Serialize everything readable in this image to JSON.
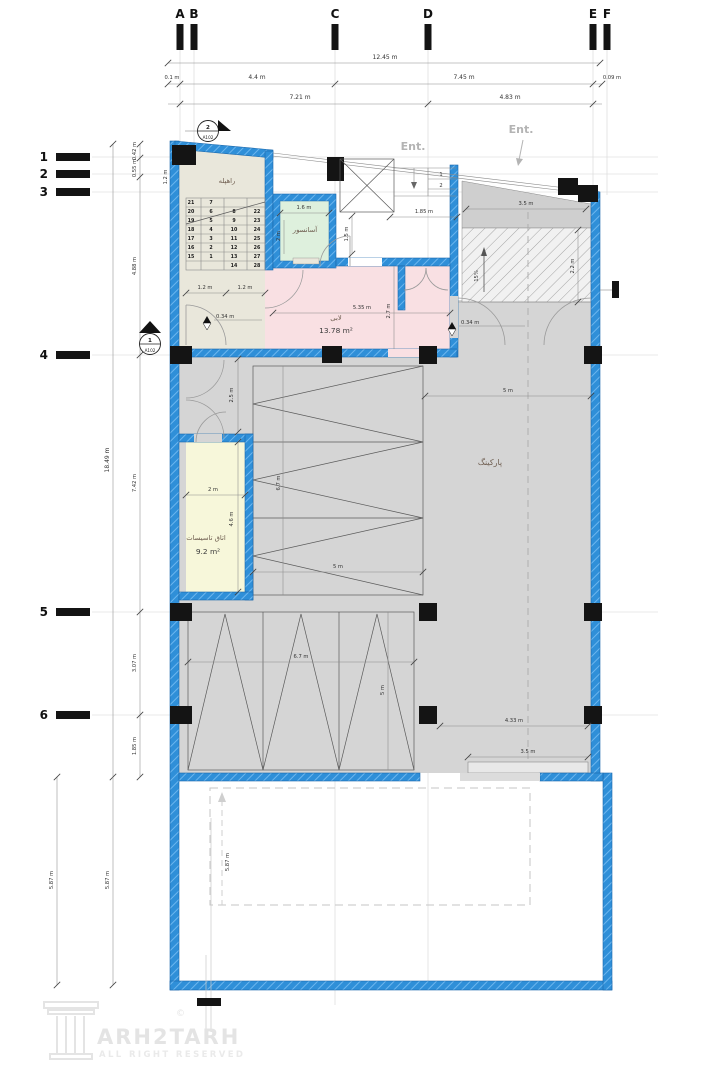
{
  "grid": {
    "cols": [
      "A",
      "B",
      "C",
      "D",
      "E",
      "F"
    ],
    "rows": [
      "1",
      "2",
      "3",
      "4",
      "5",
      "6"
    ]
  },
  "rooms": {
    "stair": {
      "name": "راهپله"
    },
    "elevator": {
      "name": "آسانسور"
    },
    "lobby": {
      "name": "لابی",
      "area": "13.78 m²"
    },
    "utility": {
      "name": "اتاق تاسیسات",
      "area": "9.2 m²"
    },
    "parking": {
      "name": "پارکینگ"
    }
  },
  "labels": {
    "ent1": "Ent.",
    "ent2": "Ent.",
    "step1": "1",
    "step2": "2"
  },
  "dims": {
    "total_top": "12.45 m",
    "seg_a": "0.1 m",
    "seg_bc": "4.4 m",
    "seg_ce": "7.45 m",
    "seg_ef": "0.09 m",
    "span_ad": "7.21 m",
    "span_de": "4.83 m",
    "row12": "0.42 m",
    "row23": "0.55 m",
    "row34": "4.88 m",
    "left_total": "18.49 m",
    "row45": "7.42 m",
    "row56": "3.07 m",
    "row6w": "1.85 m",
    "yard_left1": "5.87 m",
    "yard_left2": "5.87 m",
    "yard_inner": "5.87 m",
    "stair_top": "1.2 m",
    "stair_w1": "1.2 m",
    "stair_w2": "1.2 m",
    "elev_w": "1.6 m",
    "elev_d": "2 m",
    "vest_w": "1.85 m",
    "vest_h": "1.5 m",
    "entry_strip": "3.5 m",
    "ramp_h": "2.2 m",
    "slope": "15%",
    "lobby_w": "5.35 m",
    "lobby_h": "2.7 m",
    "level1": "0.34 m",
    "level2": "0.34 m",
    "corridor_w": "2.5 m",
    "util_w": "2 m",
    "util_h": "4.6 m",
    "stall1_len": "6.7 m",
    "stall1_w": "5 m",
    "park_w": "5 m",
    "stall2_len": "6.7 m",
    "stall2_w": "5 m",
    "park_d": "4.33 m",
    "gate_w": "3.5 m"
  },
  "stairs": {
    "c1": [
      "21",
      "20",
      "19",
      "18",
      "17",
      "16",
      "15"
    ],
    "c2": [
      "7",
      "6",
      "5",
      "4",
      "3",
      "2",
      "1"
    ],
    "c3": [
      "8",
      "9",
      "10",
      "11",
      "12",
      "13",
      "14"
    ],
    "c4": [
      "22",
      "23",
      "24",
      "25",
      "26",
      "27",
      "28"
    ]
  },
  "sections": {
    "top": {
      "num": "2",
      "sheet": "A102"
    },
    "left": {
      "num": "1",
      "sheet": "A102"
    }
  },
  "watermark": {
    "brand": "ARH2TARH",
    "copyright": "©",
    "line2": "ALL RIGHT RESERVED"
  },
  "colors": {
    "wall_blue": "#2f8fd8",
    "lobby_pink": "#f9e0e3",
    "elevator_green": "#def0dd",
    "stair_beige": "#e9e7db",
    "utility_cream": "#f7f7da",
    "parking_gray": "#d5d5d5"
  }
}
